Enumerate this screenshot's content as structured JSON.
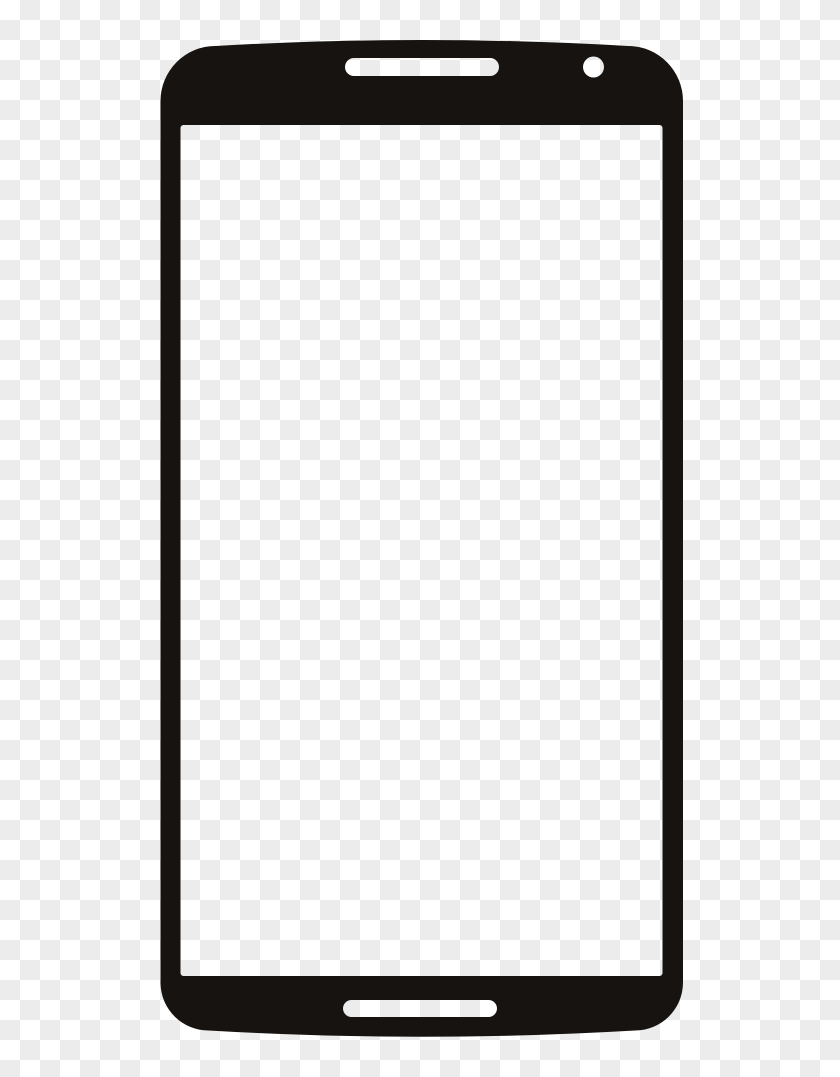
{
  "image": {
    "kind": "clipart-png-preview",
    "subject": "smartphone-front-frame-silhouette",
    "width": 840,
    "height": 1077
  },
  "background": {
    "style": "transparency-checkerboard",
    "square_size_px": 20,
    "light_hex": "#ffffff",
    "dark_hex": "#ececec"
  },
  "phone": {
    "fill_hex": "#161310",
    "rotation_deg": 0,
    "pivot": {
      "x": 421.75,
      "y": 540
    },
    "outline": {
      "left": 160.5,
      "right": 683,
      "side_top_y": 101,
      "side_bottom_y": 983,
      "top_corner_y": 46,
      "top_ctrl_y": 34,
      "top_radius": 55,
      "bottom_corner_y": 1030.5,
      "bottom_ctrl_y": 1043,
      "bottom_radius": 48
    },
    "screen_cutout": {
      "x": 180.5,
      "y": 125,
      "width": 482,
      "height": 851,
      "radius": 3
    },
    "earpiece_slot": {
      "x": 345,
      "y": 58,
      "width": 154,
      "height": 18,
      "radius": 9
    },
    "camera_hole": {
      "cx": 593.5,
      "cy": 67,
      "r": 10.5
    },
    "bottom_slot": {
      "x": 343,
      "y": 1000,
      "width": 154,
      "height": 17,
      "radius": 8.5
    }
  }
}
